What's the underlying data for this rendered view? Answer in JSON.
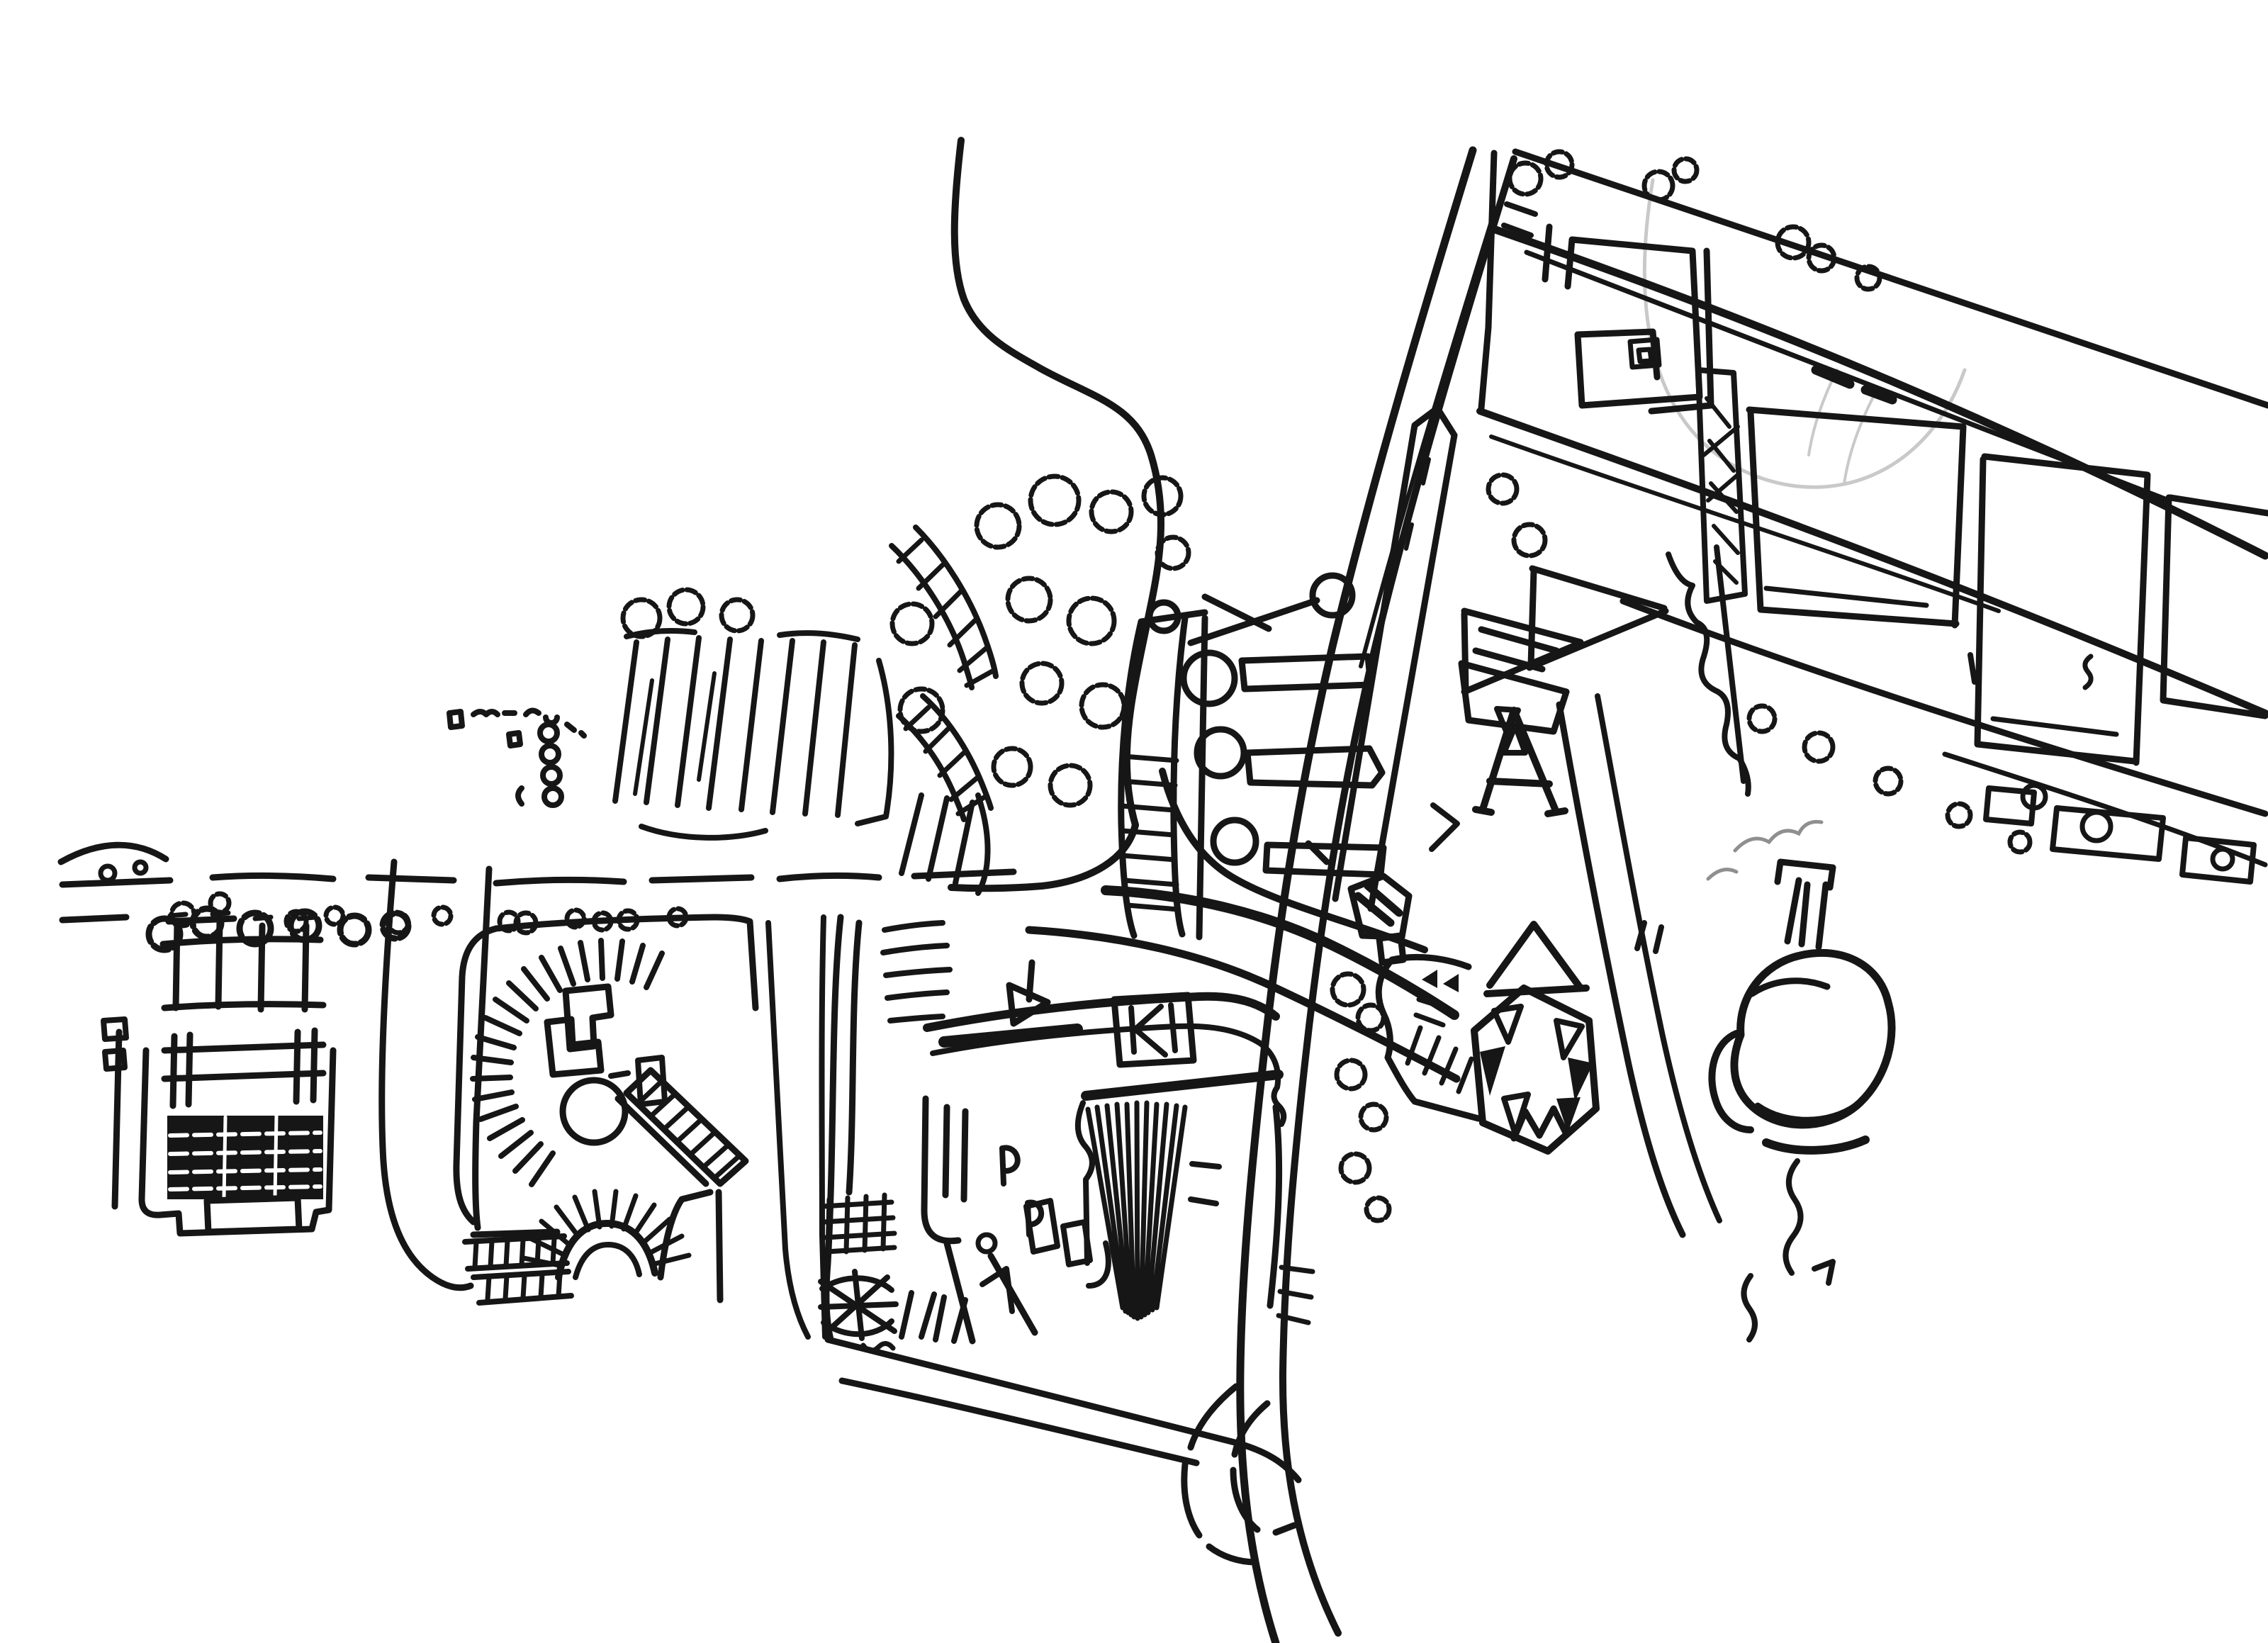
{
  "image": {
    "kind": "hand-drawn ink sketch map, aerial plan view",
    "visible_text": ""
  },
  "colors": {
    "paper": "#ffffff",
    "ink": "#161616",
    "pencil": "#c9c9c9",
    "smoke": "#8f8f8f"
  },
  "features": {
    "roads": [
      "curving access road from top",
      "east-west road with dashed edges and tree row",
      "diagonal expressway with parallel rail band",
      "north-east boulevard strip (three parallel roads)",
      "eastern side roads (one wavy-edged)",
      "cul-de-sac loop",
      "service corridor between plaza and central hall",
      "dashed hook road at bottom"
    ],
    "buildings": [
      "walled compound with dark cross-hatched hall",
      "round plaza with radial colonnade, cross pavilions, inner rotunda and arched gate",
      "terraced slash-row houses",
      "curved arcade ladder bars",
      "tall ladder tower block",
      "lollipop-shaped building rows",
      "central hall with sunburst roof and scribble-box annex",
      "grid-hatched annex and star-shaped folly",
      "spiral courtyard building",
      "hatched courtyard slab",
      "large rectangular blocks along boulevard",
      "hexagonal pavilion with triangular skylights",
      "letter-A structure with flag triangles",
      "zigzag hall with twin solid arrow marks",
      "round water tower with chimney and smoke"
    ],
    "nature": [
      "scribbled tree clusters",
      "round hedge trees",
      "faint pencil arc guideline"
    ]
  }
}
